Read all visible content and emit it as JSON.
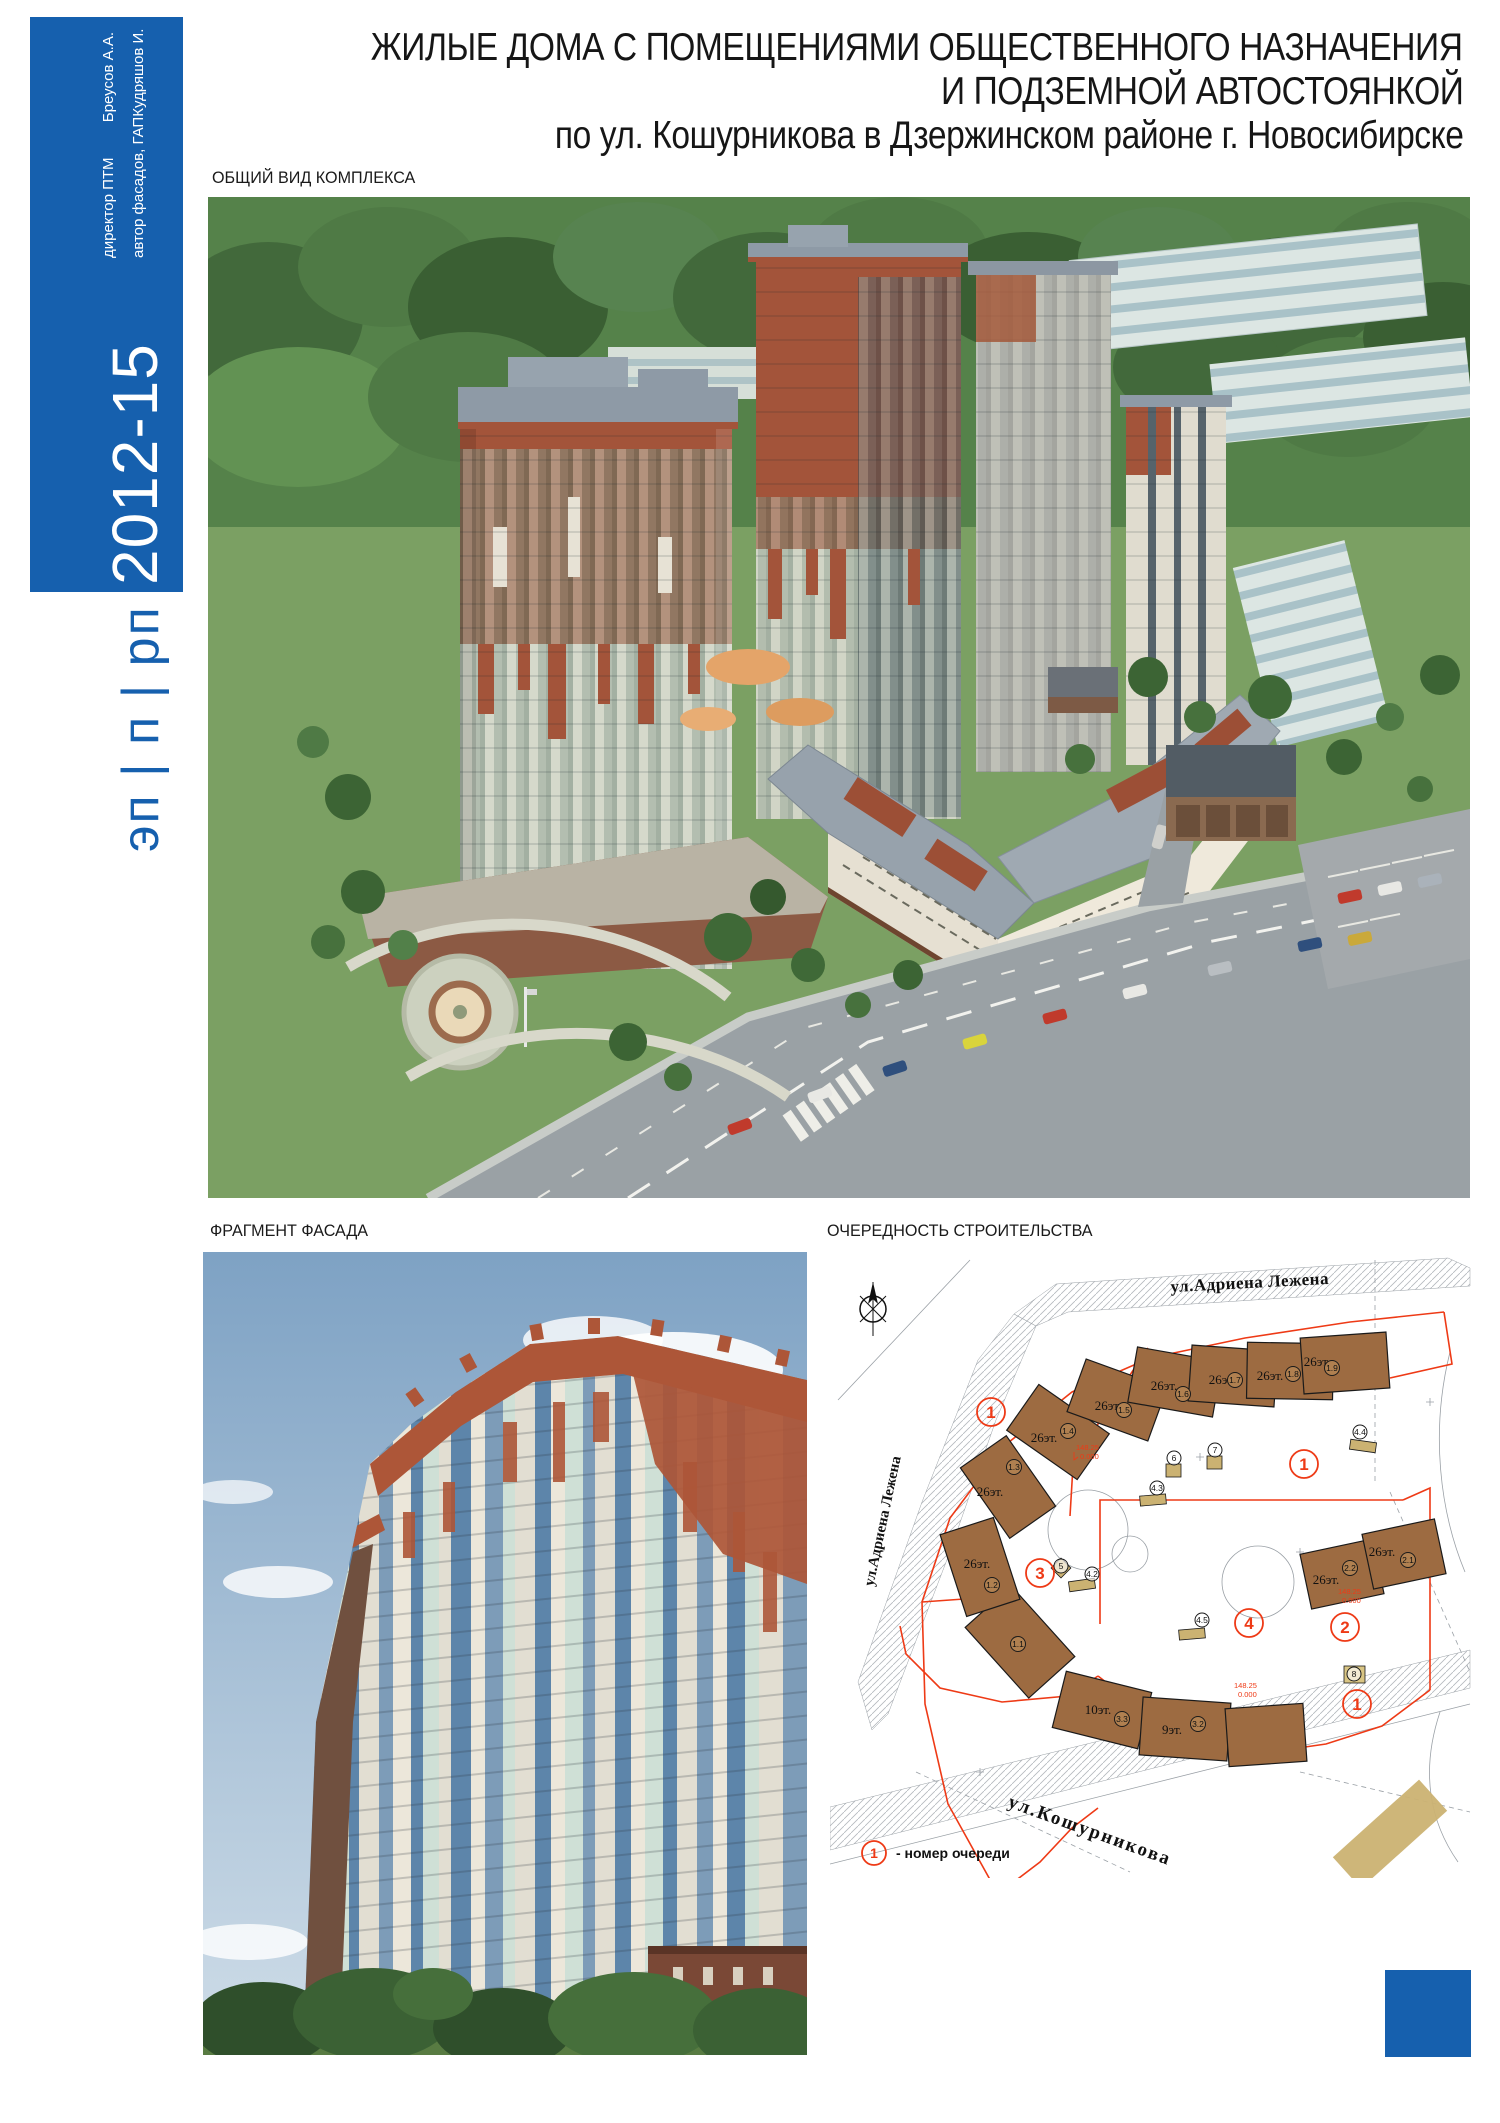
{
  "board": {
    "background": "#ffffff",
    "accent_blue": "#1660AE"
  },
  "header": {
    "title_line1": "ЖИЛЫЕ ДОМА С ПОМЕЩЕНИЯМИ ОБЩЕСТВЕННОГО НАЗНАЧЕНИЯ",
    "title_line2": "И ПОДЗЕМНОЙ АВТОСТОЯНКОЙ",
    "title_line3": "по ул. Кошурникова в Дзержинском районе г. Новосибирске"
  },
  "sidebar": {
    "credits": [
      {
        "role": "директор ПТМ",
        "name": "Бреусов А.А."
      },
      {
        "role": "автор фасадов, ГАП",
        "name": "Кудряшов И."
      }
    ],
    "years": "2012-15",
    "stage_code": "эп | п | рп"
  },
  "sections": {
    "overview_label": "ОБЩИЙ ВИД КОМПЛЕКСА",
    "facade_label": "ФРАГМЕНТ ФАСАДА",
    "phasing_label": "ОЧЕРЕДНОСТЬ СТРОИТЕЛЬСТВА"
  },
  "site_plan": {
    "street_top": "ул.Адриена Лежена",
    "street_left": "ул.Адриена Лежена",
    "street_bottom": "ул.Кошурникова",
    "legend_number": "1",
    "legend_text": "-  номер очереди",
    "phase_numbers": [
      "1",
      "1",
      "2",
      "3",
      "4",
      "1"
    ],
    "floors": {
      "f26": "26эт.",
      "f10": "10эт.",
      "f9": "9эт."
    },
    "section_ids": [
      "1.1",
      "1.2",
      "1.3",
      "1.4",
      "1.5",
      "1.6",
      "1.7",
      "1.8",
      "1.9",
      "2.1",
      "2.2",
      "3.2",
      "3.3"
    ],
    "utility_ids": [
      "4.2",
      "4.3",
      "4.4",
      "4.5",
      "5",
      "6",
      "7",
      "8"
    ],
    "elevation_note": "148.25",
    "zero_note": "0.000",
    "colors": {
      "building_fill": "#9D6B41",
      "phase_line": "#EE3A16",
      "utility_fill": "#CBB272",
      "linework": "#989da3"
    }
  }
}
